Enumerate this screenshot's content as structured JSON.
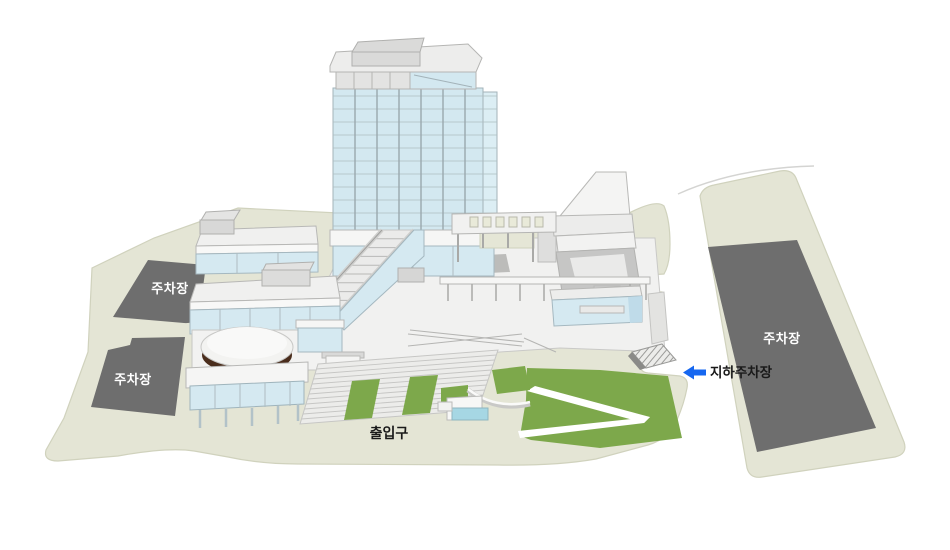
{
  "map": {
    "labels": {
      "parking_upper_left": "주차장",
      "parking_lower_left": "주차장",
      "parking_right": "주차장",
      "entrance": "출입구",
      "underground_parking": "지하주차장"
    },
    "colors": {
      "ground": "#e4e5d5",
      "parking": "#6e6e6e",
      "lawn": "#7da84b",
      "glass": "#d3e8f0",
      "glass_side": "#dceef4",
      "wall_blue": "#d5e9f1",
      "pool_blue": "#a6d7e4",
      "dome_brown": "#4a2d1c",
      "arrow": "#1667f0",
      "label_on_dark": "#ffffff",
      "label_on_light": "#1a1a1a"
    },
    "icons": {
      "underground_arrow": "arrow-left-icon"
    }
  }
}
